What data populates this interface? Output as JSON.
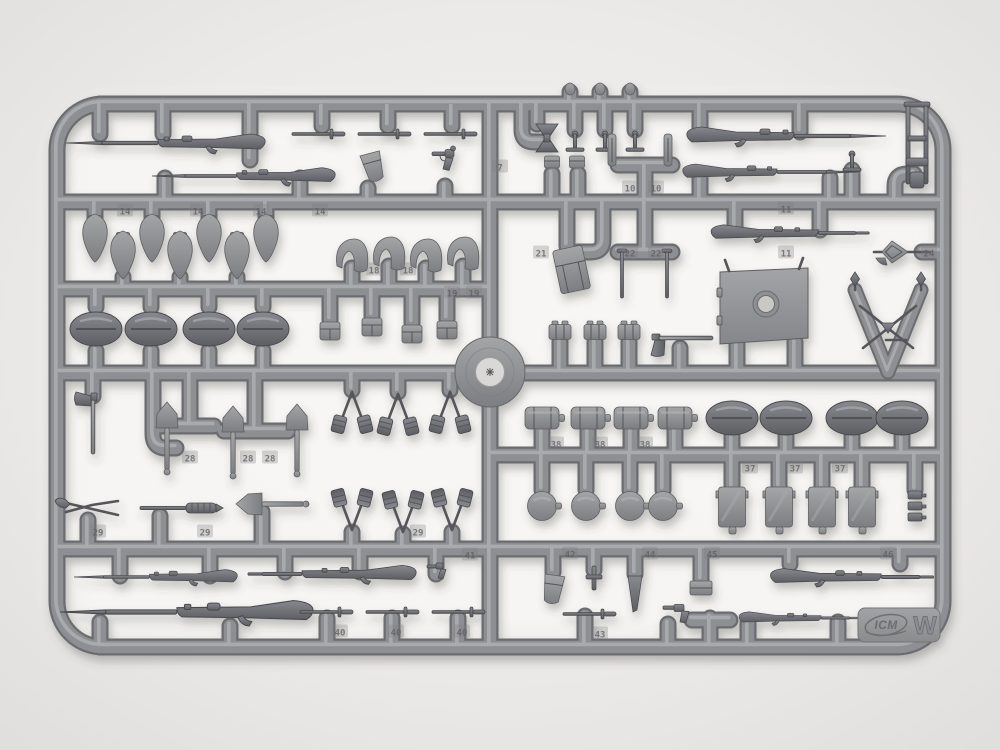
{
  "scene": {
    "description": "Gray injection-molded plastic model-kit sprue (parts frame) photographed on a light background",
    "brand_logo": "ICM",
    "sprue_letter": "W"
  },
  "colors": {
    "background": "#eceae8",
    "plastic": "#8e8f92",
    "plastic_dark": "#606165",
    "plastic_light": "#bcbdbf",
    "shadow": "#44423e"
  },
  "mold_number_tags": [
    {
      "n": "14",
      "x": 125,
      "y": 212
    },
    {
      "n": "14",
      "x": 198,
      "y": 212
    },
    {
      "n": "14",
      "x": 261,
      "y": 212
    },
    {
      "n": "14",
      "x": 320,
      "y": 212
    },
    {
      "n": "18",
      "x": 374,
      "y": 271
    },
    {
      "n": "18",
      "x": 408,
      "y": 271
    },
    {
      "n": "19",
      "x": 452,
      "y": 294
    },
    {
      "n": "19",
      "x": 474,
      "y": 294
    },
    {
      "n": "7",
      "x": 500,
      "y": 168
    },
    {
      "n": "10",
      "x": 630,
      "y": 189
    },
    {
      "n": "10",
      "x": 656,
      "y": 189
    },
    {
      "n": "11",
      "x": 786,
      "y": 210
    },
    {
      "n": "11",
      "x": 786,
      "y": 254
    },
    {
      "n": "21",
      "x": 541,
      "y": 254
    },
    {
      "n": "22",
      "x": 630,
      "y": 254
    },
    {
      "n": "22",
      "x": 656,
      "y": 254
    },
    {
      "n": "24",
      "x": 929,
      "y": 254
    },
    {
      "n": "28",
      "x": 190,
      "y": 459
    },
    {
      "n": "28",
      "x": 248,
      "y": 459
    },
    {
      "n": "28",
      "x": 270,
      "y": 459
    },
    {
      "n": "29",
      "x": 98,
      "y": 533
    },
    {
      "n": "29",
      "x": 205,
      "y": 533
    },
    {
      "n": "29",
      "x": 418,
      "y": 533
    },
    {
      "n": "38",
      "x": 556,
      "y": 445
    },
    {
      "n": "38",
      "x": 600,
      "y": 445
    },
    {
      "n": "38",
      "x": 645,
      "y": 445
    },
    {
      "n": "37",
      "x": 750,
      "y": 469
    },
    {
      "n": "37",
      "x": 795,
      "y": 469
    },
    {
      "n": "37",
      "x": 840,
      "y": 469
    },
    {
      "n": "40",
      "x": 340,
      "y": 633
    },
    {
      "n": "40",
      "x": 396,
      "y": 633
    },
    {
      "n": "40",
      "x": 462,
      "y": 633
    },
    {
      "n": "41",
      "x": 470,
      "y": 556
    },
    {
      "n": "42",
      "x": 570,
      "y": 555
    },
    {
      "n": "44",
      "x": 650,
      "y": 555
    },
    {
      "n": "45",
      "x": 712,
      "y": 555
    },
    {
      "n": "46",
      "x": 888,
      "y": 555
    },
    {
      "n": "43",
      "x": 600,
      "y": 635
    }
  ],
  "part_groups": [
    {
      "name": "rifles",
      "count": 10
    },
    {
      "name": "small-bayonets",
      "count": 7
    },
    {
      "name": "bayonet-scabbard-covers",
      "count": 7
    },
    {
      "name": "side-caps",
      "count": 4
    },
    {
      "name": "helmets",
      "count": 8
    },
    {
      "name": "ammo-pouches",
      "count": 9
    },
    {
      "name": "entrenching-shovels",
      "count": 4
    },
    {
      "name": "grenade-bundles",
      "count": 6
    },
    {
      "name": "axes",
      "count": 2
    },
    {
      "name": "wire-cutters",
      "count": 1
    },
    {
      "name": "trench-club",
      "count": 1
    },
    {
      "name": "mess-tins",
      "count": 4
    },
    {
      "name": "canteen-flasks",
      "count": 4
    },
    {
      "name": "bread-bags",
      "count": 4
    },
    {
      "name": "mg-shield",
      "count": 1
    },
    {
      "name": "mg-mount-frame",
      "count": 1
    },
    {
      "name": "trophy-v-frame",
      "count": 1
    },
    {
      "name": "pistols",
      "count": 3
    },
    {
      "name": "holsters",
      "count": 2
    },
    {
      "name": "map-case",
      "count": 1
    },
    {
      "name": "cleaning-rods",
      "count": 2
    }
  ]
}
